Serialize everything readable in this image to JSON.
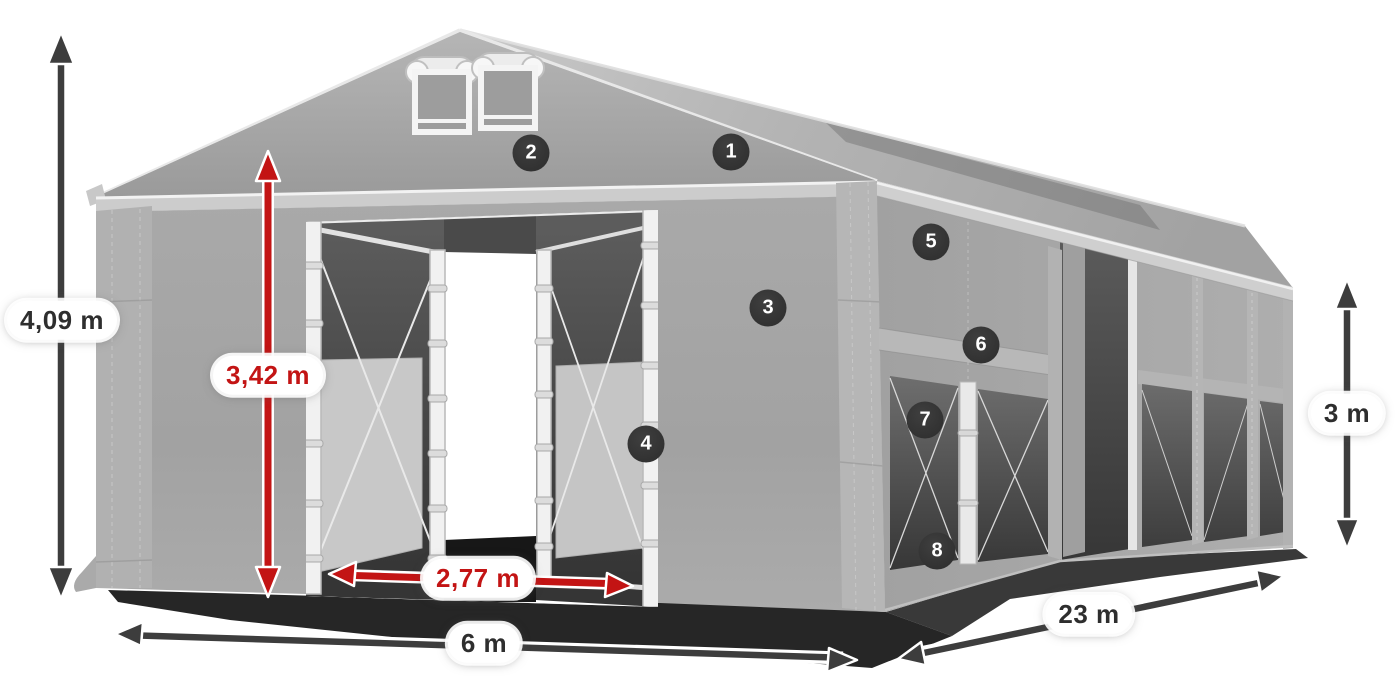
{
  "scene": {
    "description": "Gray marquee tent dimension diagram with numbered part callouts",
    "background": "#ffffff"
  },
  "colors": {
    "accent_red": "#c31414",
    "arrow_dark": "#3d3d3d",
    "badge_background": "#333333",
    "badge_text": "#ffffff",
    "label_text_dark": "#2e2e2e",
    "label_pill_background": "#ffffff",
    "tent_fabric_gray": "#a5a5a5"
  },
  "dimension_labels": {
    "total_height": "4,09 m",
    "inner_height": "3,42 m",
    "entrance_width": "2,77 m",
    "tent_width": "6 m",
    "tent_length": "23 m",
    "side_height": "3 m"
  },
  "callout_markers": [
    {
      "label": "1"
    },
    {
      "label": "2"
    },
    {
      "label": "3"
    },
    {
      "label": "4"
    },
    {
      "label": "5"
    },
    {
      "label": "6"
    },
    {
      "label": "7"
    },
    {
      "label": "8"
    }
  ]
}
